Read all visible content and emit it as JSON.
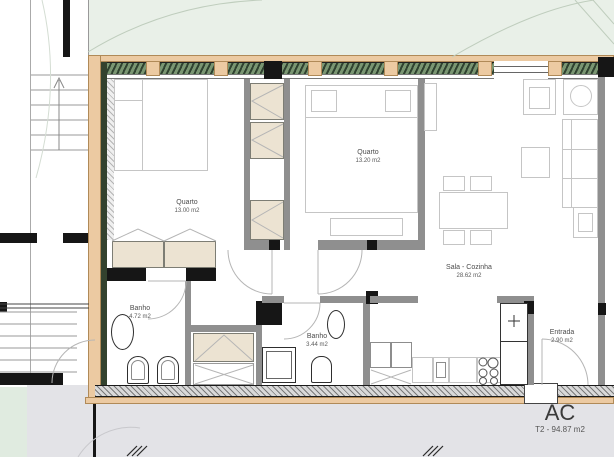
{
  "plan": {
    "title": "AC",
    "total": "T2 - 94.87 m2",
    "rooms": [
      {
        "label": "Quarto",
        "area": "13.00 m2"
      },
      {
        "label": "Quarto",
        "area": "13.20 m2"
      },
      {
        "label": "Sala - Cozinha",
        "area": "28.62 m2"
      },
      {
        "label": "Banho",
        "area": "4.72 m2"
      },
      {
        "label": "Banho",
        "area": "3.44 m2"
      },
      {
        "label": "Entrada",
        "area": "2.90 m2"
      }
    ],
    "colors": {
      "exterior_wall": "#ECCAA2",
      "interior_wall": "#8F8F8F",
      "structural_wall": "#161616",
      "glazing": "#5E7A58",
      "garden": "#E9F0E8",
      "paving": "#E3E3E7",
      "cabinet_fill": "#ECE3D2"
    }
  }
}
